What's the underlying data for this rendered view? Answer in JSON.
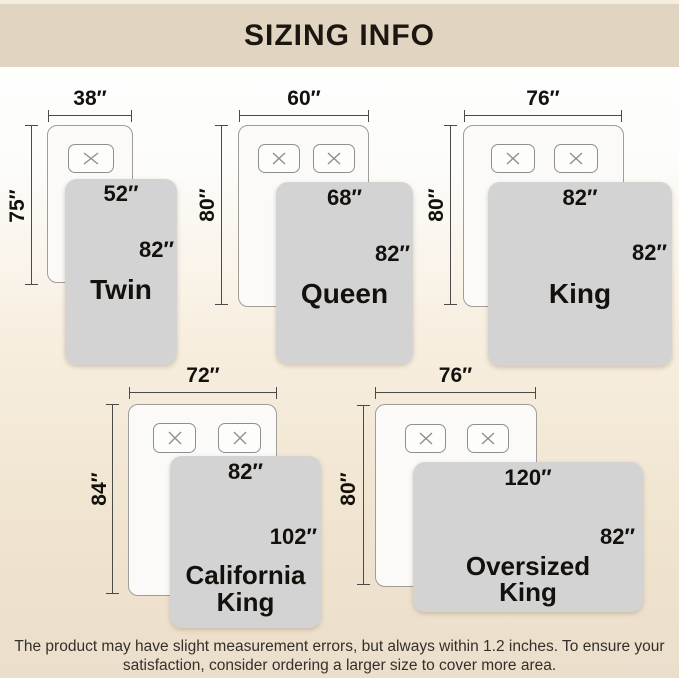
{
  "header": {
    "title": "SIZING INFO"
  },
  "sizes": [
    {
      "name": "Twin",
      "label": "Twin",
      "bed_width": "38″",
      "bed_height": "75″",
      "blanket_width": "52″",
      "blanket_length": "82″"
    },
    {
      "name": "Queen",
      "label": "Queen",
      "bed_width": "60″",
      "bed_height": "80″",
      "blanket_width": "68″",
      "blanket_length": "82″"
    },
    {
      "name": "King",
      "label": "King",
      "bed_width": "76″",
      "bed_height": "80″",
      "blanket_width": "82″",
      "blanket_length": "82″"
    },
    {
      "name": "California King",
      "label": "California\nKing",
      "bed_width": "72″",
      "bed_height": "84″",
      "blanket_width": "82″",
      "blanket_length": "102″"
    },
    {
      "name": "Oversized King",
      "label": "Oversized\nKing",
      "bed_width": "76″",
      "bed_height": "80″",
      "blanket_width": "120″",
      "blanket_length": "82″"
    }
  ],
  "footer": {
    "line1": "The product may have slight measurement errors, but always within 1.2 inches. To ensure your",
    "line2": "satisfaction, consider ordering a larger size to cover more area."
  },
  "icons": {
    "pillow_cross": "✕"
  },
  "colors": {
    "header_bar": "#e1d5c1",
    "blanket_gray": "#d3d3d3",
    "background_bottom": "#ebdecb",
    "measure_line": "#4a4a4a",
    "text": "#14110d"
  }
}
